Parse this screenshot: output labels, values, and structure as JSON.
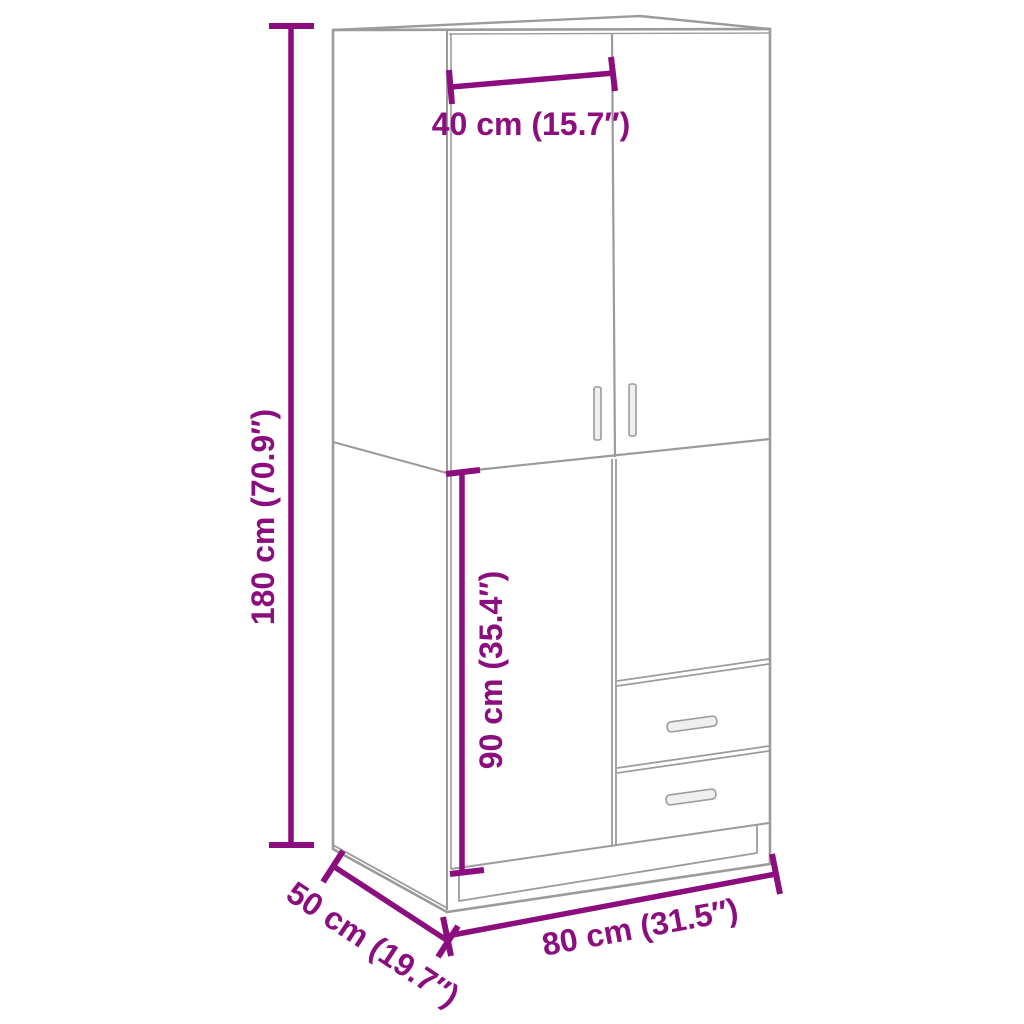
{
  "diagram": {
    "type": "product-dimension-diagram",
    "subject": "wardrobe",
    "background_color": "#ffffff",
    "outline_color": "#9b9b9b",
    "dimension_color": "#8B0D7E",
    "labels": {
      "height": "180 cm (70.9″)",
      "door_width": "40 cm (15.7″)",
      "lower_section_height": "90 cm (35.4″)",
      "width": "80 cm (31.5″)",
      "depth": "50 cm (19.7″)"
    }
  }
}
